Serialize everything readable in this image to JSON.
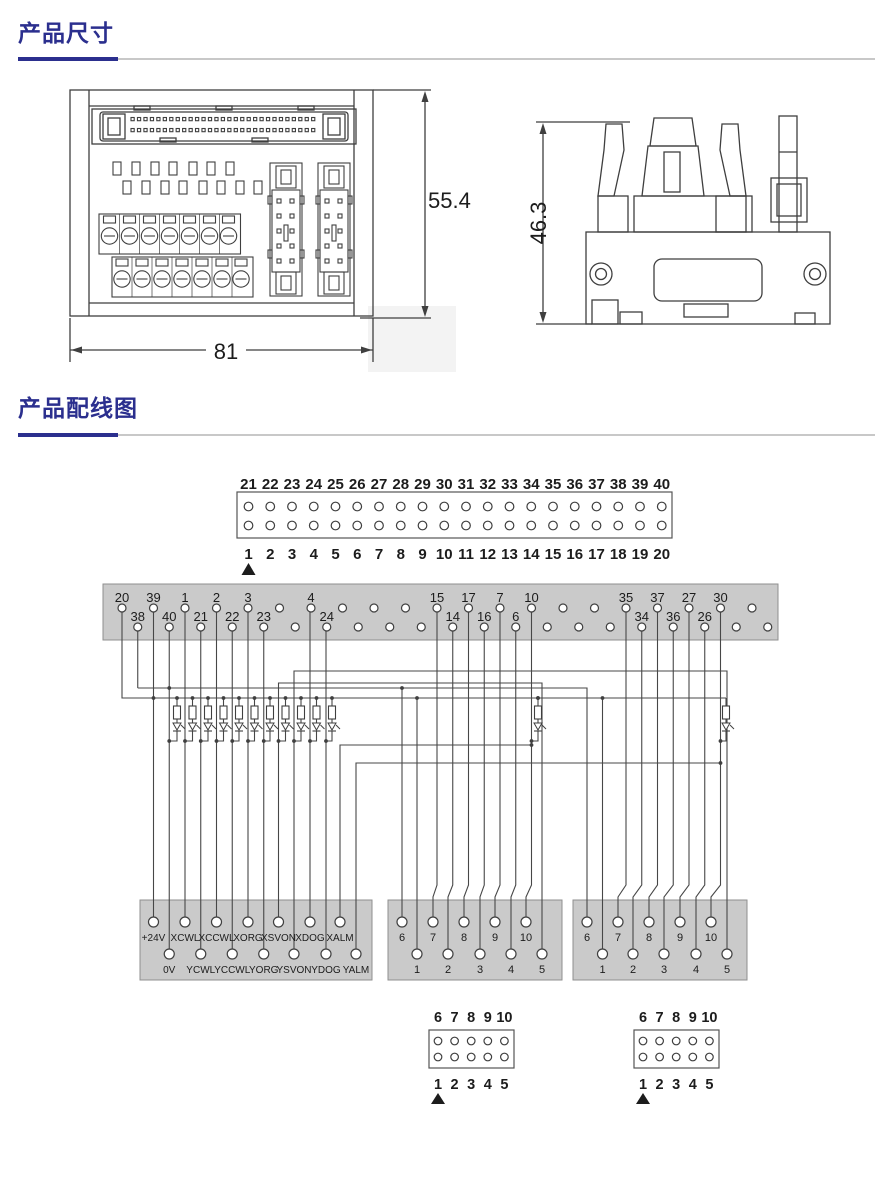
{
  "colors": {
    "accent": "#2b2f8e",
    "rule_gray": "#c8c8c8",
    "bar_fill": "#cacaca",
    "line": "#474747"
  },
  "sections": {
    "dimensions_title": "产品尺寸",
    "wiring_title": "产品配线图"
  },
  "dims": {
    "front_width": "81",
    "front_height": "55.4",
    "side_height": "46.3"
  },
  "wiring": {
    "connector40": {
      "top_numbers": [
        "21",
        "22",
        "23",
        "24",
        "25",
        "26",
        "27",
        "28",
        "29",
        "30",
        "31",
        "32",
        "33",
        "34",
        "35",
        "36",
        "37",
        "38",
        "39",
        "40"
      ],
      "bottom_numbers": [
        "1",
        "2",
        "3",
        "4",
        "5",
        "6",
        "7",
        "8",
        "9",
        "10",
        "11",
        "12",
        "13",
        "14",
        "15",
        "16",
        "17",
        "18",
        "19",
        "20"
      ]
    },
    "bar": {
      "top_labels": [
        "20",
        "39",
        "1",
        "2",
        "3",
        "",
        "4",
        "",
        "",
        "",
        "15",
        "17",
        "7",
        "10",
        "",
        "",
        "35",
        "37",
        "27",
        "30",
        ""
      ],
      "bottom_labels": [
        "38",
        "40",
        "21",
        "22",
        "23",
        "",
        "24",
        "",
        "",
        "",
        "14",
        "16",
        "6",
        "",
        "",
        "",
        "34",
        "36",
        "26",
        "",
        ""
      ]
    },
    "left_block": {
      "top": [
        "+24V",
        "XCWL",
        "XCCWL",
        "XORG",
        "XSVON",
        "XDOG",
        "XALM"
      ],
      "bottom": [
        "0V",
        "YCWL",
        "YCCWL",
        "YORG",
        "YSVON",
        "YDOG",
        "YALM"
      ]
    },
    "mid_block": {
      "top": [
        "6",
        "7",
        "8",
        "9",
        "10"
      ],
      "bottom": [
        "1",
        "2",
        "3",
        "4",
        "5"
      ]
    },
    "right_block": {
      "top": [
        "6",
        "7",
        "8",
        "9",
        "10"
      ],
      "bottom": [
        "1",
        "2",
        "3",
        "4",
        "5"
      ]
    },
    "bottom_connector_left": {
      "top": [
        "6",
        "7",
        "8",
        "9",
        "10"
      ],
      "bottom": [
        "1",
        "2",
        "3",
        "4",
        "5"
      ]
    },
    "bottom_connector_right": {
      "top": [
        "6",
        "7",
        "8",
        "9",
        "10"
      ],
      "bottom": [
        "1",
        "2",
        "3",
        "4",
        "5"
      ]
    }
  }
}
